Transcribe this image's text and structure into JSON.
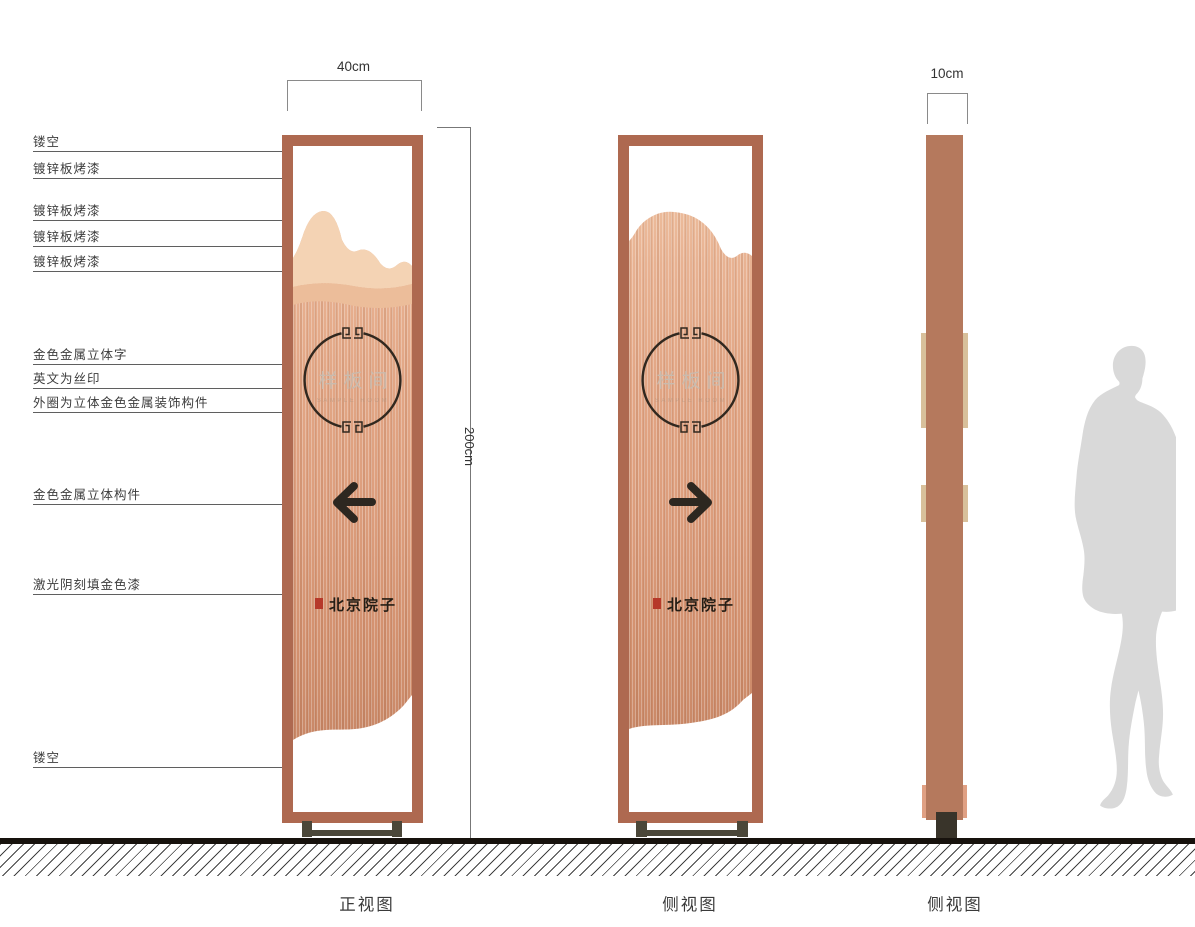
{
  "callouts": [
    {
      "text": "镂空"
    },
    {
      "text": "镀锌板烤漆"
    },
    {
      "text": "镀锌板烤漆"
    },
    {
      "text": "镀锌板烤漆"
    },
    {
      "text": "镀锌板烤漆"
    },
    {
      "text": "金色金属立体字"
    },
    {
      "text": "英文为丝印"
    },
    {
      "text": "外圈为立体金色金属装饰构件"
    },
    {
      "text": "金色金属立体构件"
    },
    {
      "text": "激光阴刻填金色漆"
    },
    {
      "text": "镂空"
    }
  ],
  "dimensions": {
    "front_width": "40cm",
    "side_width": "10cm",
    "height": "200cm"
  },
  "sign": {
    "circle_text": "样板间",
    "english_subtext": "SAMPLE ROOM",
    "brand_text": "北京院子"
  },
  "views": [
    {
      "caption": "正视图"
    },
    {
      "caption": "侧视图"
    },
    {
      "caption": "侧视图"
    }
  ],
  "colors": {
    "frame": "#ae6950",
    "wood_light": "#f0c5a4",
    "wood_mid": "#e2a585",
    "wood_dark": "#c4815f",
    "side_column": "#b5795d",
    "accent_strip": "#d8c09b",
    "foot": "#4b4739",
    "ground": "#17120d",
    "silhouette": "#d9d9d9",
    "seal_red": "#b6392a",
    "ink": "#2b231c"
  }
}
